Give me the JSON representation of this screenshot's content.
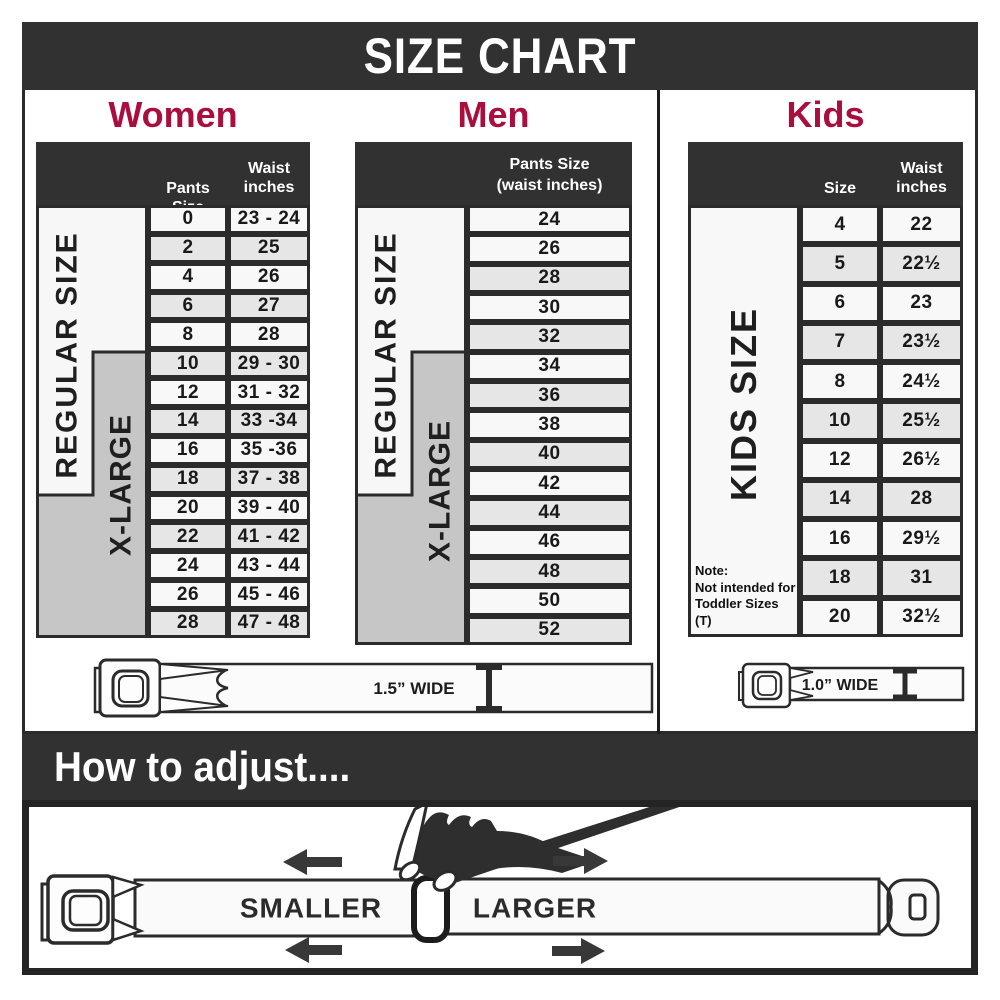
{
  "banner": {
    "title": "SIZE CHART"
  },
  "colors": {
    "dark_band": "#313131",
    "heading_crimson": "#aa0e3e",
    "row_white": "#f8f8f8",
    "row_gray": "#e6e6e6",
    "xlarge_gray": "#c6c6c6",
    "border_dark": "#2b2b2b"
  },
  "women": {
    "title": "Women",
    "col_pants": "Pants Size",
    "col_waist_line1": "Waist",
    "col_waist_line2": "inches",
    "regular_label": "REGULAR SIZE",
    "xlarge_label": "X-LARGE",
    "rows": [
      {
        "cells": [
          "0",
          "23 - 24"
        ],
        "gray": false
      },
      {
        "cells": [
          "2",
          "25"
        ],
        "gray": true
      },
      {
        "cells": [
          "4",
          "26"
        ],
        "gray": false
      },
      {
        "cells": [
          "6",
          "27"
        ],
        "gray": true
      },
      {
        "cells": [
          "8",
          "28"
        ],
        "gray": false
      },
      {
        "cells": [
          "10",
          "29 - 30"
        ],
        "gray": true
      },
      {
        "cells": [
          "12",
          "31 - 32"
        ],
        "gray": false
      },
      {
        "cells": [
          "14",
          "33 -34"
        ],
        "gray": true
      },
      {
        "cells": [
          "16",
          "35 -36"
        ],
        "gray": false
      },
      {
        "cells": [
          "18",
          "37 - 38"
        ],
        "gray": true
      },
      {
        "cells": [
          "20",
          "39 - 40"
        ],
        "gray": false
      },
      {
        "cells": [
          "22",
          "41 - 42"
        ],
        "gray": true
      },
      {
        "cells": [
          "24",
          "43 - 44"
        ],
        "gray": false
      },
      {
        "cells": [
          "26",
          "45 - 46"
        ],
        "gray": false
      },
      {
        "cells": [
          "28",
          "47 - 48"
        ],
        "gray": true
      }
    ]
  },
  "men": {
    "title": "Men",
    "header_line1": "Pants Size",
    "header_line2": "(waist inches)",
    "regular_label": "REGULAR SIZE",
    "xlarge_label": "X-LARGE",
    "rows": [
      {
        "cells": [
          "24"
        ],
        "gray": false
      },
      {
        "cells": [
          "26"
        ],
        "gray": false
      },
      {
        "cells": [
          "28"
        ],
        "gray": true
      },
      {
        "cells": [
          "30"
        ],
        "gray": false
      },
      {
        "cells": [
          "32"
        ],
        "gray": true
      },
      {
        "cells": [
          "34"
        ],
        "gray": false
      },
      {
        "cells": [
          "36"
        ],
        "gray": true
      },
      {
        "cells": [
          "38"
        ],
        "gray": false
      },
      {
        "cells": [
          "40"
        ],
        "gray": true
      },
      {
        "cells": [
          "42"
        ],
        "gray": false
      },
      {
        "cells": [
          "44"
        ],
        "gray": true
      },
      {
        "cells": [
          "46"
        ],
        "gray": false
      },
      {
        "cells": [
          "48"
        ],
        "gray": true
      },
      {
        "cells": [
          "50"
        ],
        "gray": false
      },
      {
        "cells": [
          "52"
        ],
        "gray": true
      }
    ]
  },
  "kids": {
    "title": "Kids",
    "col_size": "Size",
    "col_waist_line1": "Waist",
    "col_waist_line2": "inches",
    "size_label": "KIDS SIZE",
    "note_line1": "Note:",
    "note_line2": "Not intended for",
    "note_line3": "Toddler Sizes (T)",
    "rows": [
      {
        "cells": [
          "4",
          "22"
        ],
        "gray": false
      },
      {
        "cells": [
          "5",
          "22½"
        ],
        "gray": true
      },
      {
        "cells": [
          "6",
          "23"
        ],
        "gray": false
      },
      {
        "cells": [
          "7",
          "23½"
        ],
        "gray": true
      },
      {
        "cells": [
          "8",
          "24½"
        ],
        "gray": false
      },
      {
        "cells": [
          "10",
          "25½"
        ],
        "gray": true
      },
      {
        "cells": [
          "12",
          "26½"
        ],
        "gray": false
      },
      {
        "cells": [
          "14",
          "28"
        ],
        "gray": true
      },
      {
        "cells": [
          "16",
          "29½"
        ],
        "gray": false
      },
      {
        "cells": [
          "18",
          "31"
        ],
        "gray": true
      },
      {
        "cells": [
          "20",
          "32½"
        ],
        "gray": false
      }
    ]
  },
  "belts": {
    "adult_width_label": "1.5” WIDE",
    "kids_width_label": "1.0” WIDE"
  },
  "adjust": {
    "title": "How to adjust....",
    "smaller": "SMALLER",
    "larger": "LARGER"
  }
}
